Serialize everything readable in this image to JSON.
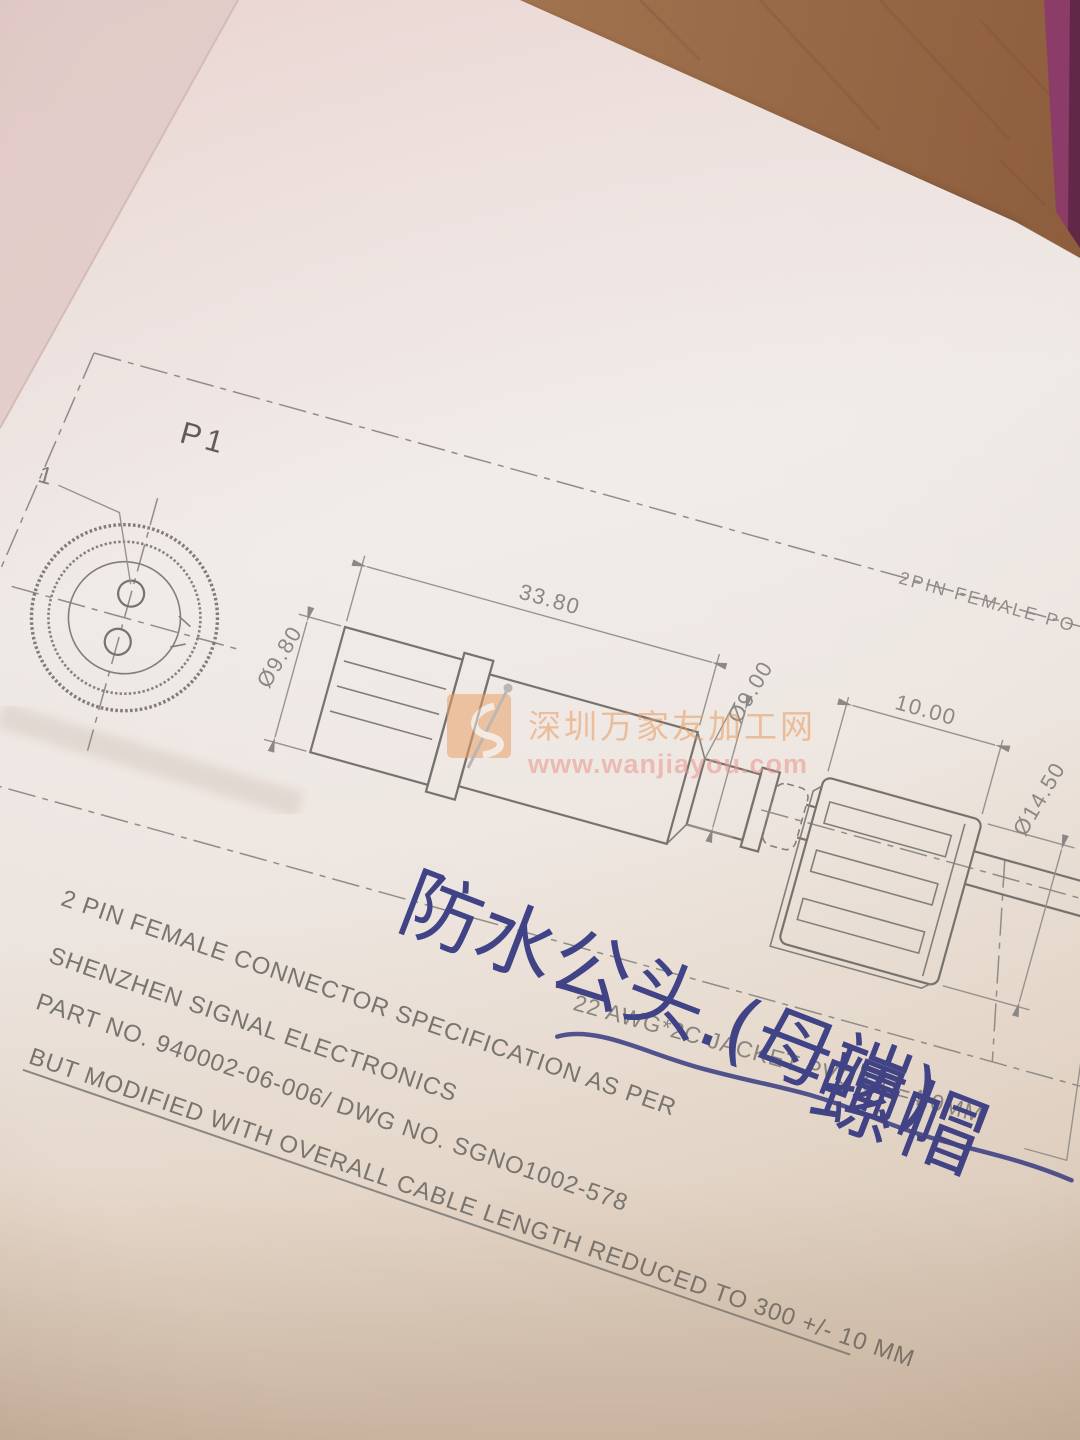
{
  "drawing": {
    "view_label": "P1",
    "pin_label": "1",
    "top_note": "2PIN FEMALE PO",
    "dims": {
      "overall_length": "33.80",
      "rear_od": "Ø9.80",
      "front_od": "Ø9.00",
      "nut_len": "10.00",
      "nut_od": "Ø14.50"
    },
    "cable_note": "22 AWG*2C JACKET PVC OD=4.0MM",
    "spec_lines": [
      "2 PIN FEMALE CONNECTOR SPECIFICATION AS PER",
      "SHENZHEN SIGNAL ELECTRONICS",
      "PART NO.  940002-06-006/ DWG NO. SGNO1002-578",
      "BUT MODIFIED WITH OVERALL CABLE LENGTH REDUCED TO 300 +/- 10 MM"
    ]
  },
  "annotations": {
    "waterproof_note": "防水公头.(母端)",
    "nut_note": "螺帽"
  },
  "watermark": {
    "site_name": "深圳万家友加工网",
    "site_url": "www.wanjiayou.com"
  },
  "colors": {
    "pen_blue": "#3e4185",
    "pencil_gray": "#8a8784",
    "watermark_orange": "#e89a5f",
    "wood_brown": "#a0714c",
    "book_edge_purple": "#8c3a68",
    "paper_pink": "#ecd8d5"
  }
}
